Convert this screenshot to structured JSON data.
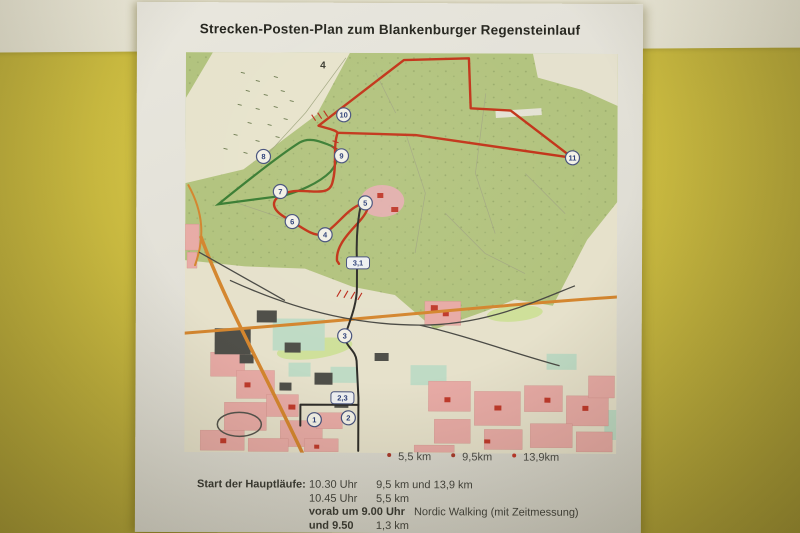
{
  "photo": {
    "wall_yellow": "#cdbd41",
    "wall_white_band": "#e9e6d5",
    "paper_color": "#e2e0d7"
  },
  "poster": {
    "title": "Strecken-Posten-Plan zum Blankenburger Regensteinlauf"
  },
  "map": {
    "colors": {
      "forest": "#b2c37e",
      "field": "#e7e3cc",
      "lowland": "#e6e1cb",
      "town_pink": "#e8aba6",
      "route_red": "#c23318",
      "route_green": "#3a7d33",
      "route_black": "#2e2d29",
      "road_orange": "#d4862f"
    },
    "markers": [
      {
        "label": "4",
        "x": 137,
        "y": 13,
        "type": "plain"
      },
      {
        "label": "10",
        "x": 158,
        "y": 62,
        "type": "circle"
      },
      {
        "label": "8",
        "x": 78,
        "y": 104,
        "type": "circle"
      },
      {
        "label": "9",
        "x": 156,
        "y": 103,
        "type": "circle"
      },
      {
        "label": "7",
        "x": 95,
        "y": 139,
        "type": "circle"
      },
      {
        "label": "6",
        "x": 107,
        "y": 169,
        "type": "circle"
      },
      {
        "label": "5",
        "x": 180,
        "y": 150,
        "type": "circle"
      },
      {
        "label": "4",
        "x": 140,
        "y": 182,
        "type": "circle"
      },
      {
        "label": "11",
        "x": 387,
        "y": 104,
        "type": "circle"
      },
      {
        "label": "3,1",
        "x": 173,
        "y": 210,
        "type": "pill"
      },
      {
        "label": "3",
        "x": 160,
        "y": 283,
        "type": "circle"
      },
      {
        "label": "2,3",
        "x": 158,
        "y": 345,
        "type": "pill"
      },
      {
        "label": "1",
        "x": 130,
        "y": 367,
        "type": "circle"
      },
      {
        "label": "2",
        "x": 164,
        "y": 365,
        "type": "circle"
      }
    ]
  },
  "legend": {
    "items": [
      {
        "label": "5,5 km",
        "color": "#a93a2c"
      },
      {
        "label": "9,5km",
        "color": "#a93a2c"
      },
      {
        "label": "13,9km",
        "color": "#c0392b"
      }
    ]
  },
  "schedule": {
    "label": "Start der Hauptläufe:",
    "rows": [
      {
        "time": "10.30 Uhr",
        "detail": "9,5 km und 13,9  km"
      },
      {
        "time": "10.45 Uhr",
        "detail": "5,5 km"
      },
      {
        "time": "vorab um 9.00 Uhr",
        "detail": "Nordic Walking (mit Zeitmessung)"
      },
      {
        "time": "und 9.50",
        "detail": "1,3 km"
      }
    ]
  }
}
